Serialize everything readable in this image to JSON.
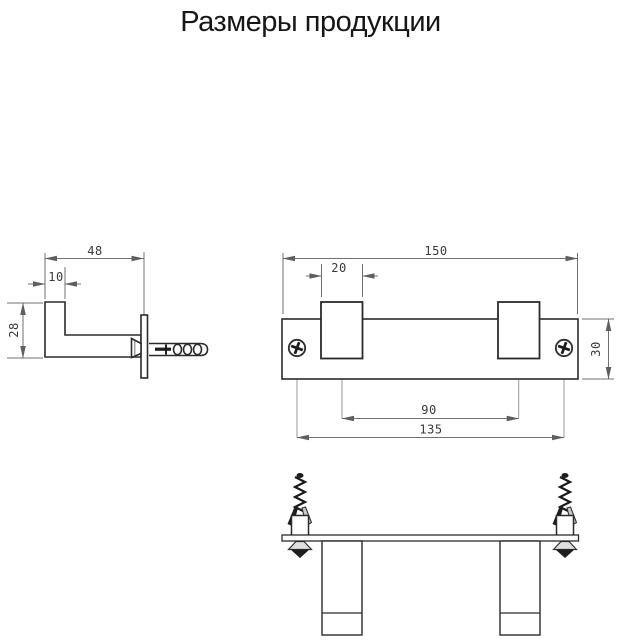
{
  "title": "Размеры продукции",
  "colors": {
    "background": "#ffffff",
    "object_line": "#2b2b2b",
    "dimension_line": "#707070",
    "text": "#3a3a3a"
  },
  "side_view": {
    "total_depth": "48",
    "hook_thickness": "10",
    "hook_height": "28"
  },
  "front_view": {
    "total_length": "150",
    "hook_width": "20",
    "plate_height": "30",
    "hook_spacing": "90",
    "hole_spacing": "135"
  }
}
